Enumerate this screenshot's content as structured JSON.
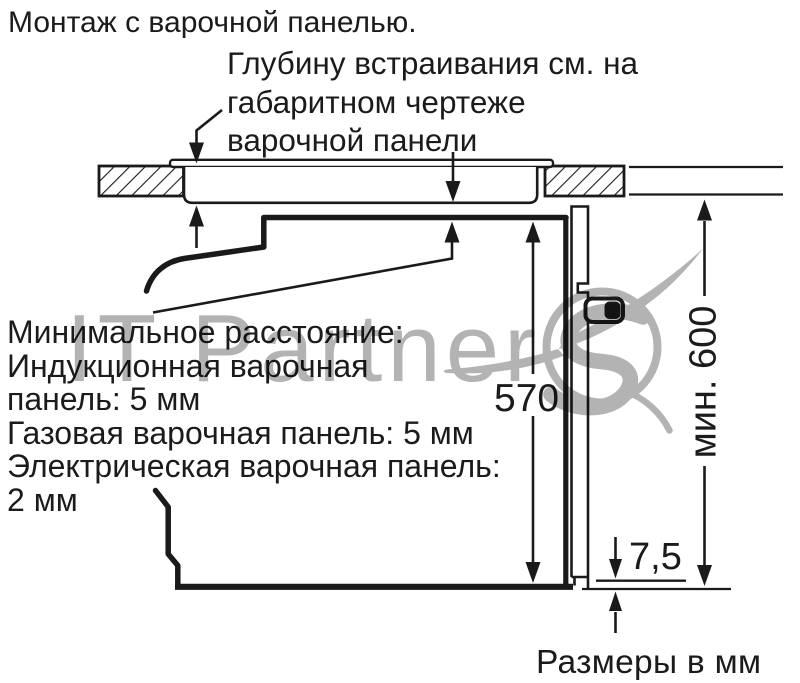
{
  "title": "Монтаж с варочной панелью.",
  "hob_note": {
    "lines": [
      "Глубину встраивания см. на",
      "габаритном чертеже",
      "варочной панели"
    ]
  },
  "min_distance": {
    "lines": [
      "Минимальное расстояние:",
      "Индукционная варочная",
      "панель: 5 мм",
      "Газовая варочная панель: 5 мм",
      "Электрическая варочная панель:",
      "2 мм"
    ]
  },
  "dimensions": {
    "oven_niche_height": "570",
    "min_cabinet_height": "мин. 600",
    "bottom_gap": "7,5",
    "units_note": "Размеры в мм"
  },
  "watermark": {
    "text": "IT Partner"
  },
  "colors": {
    "line": "#1a1a1a",
    "watermark": "#b3b3b3",
    "background": "#ffffff"
  }
}
